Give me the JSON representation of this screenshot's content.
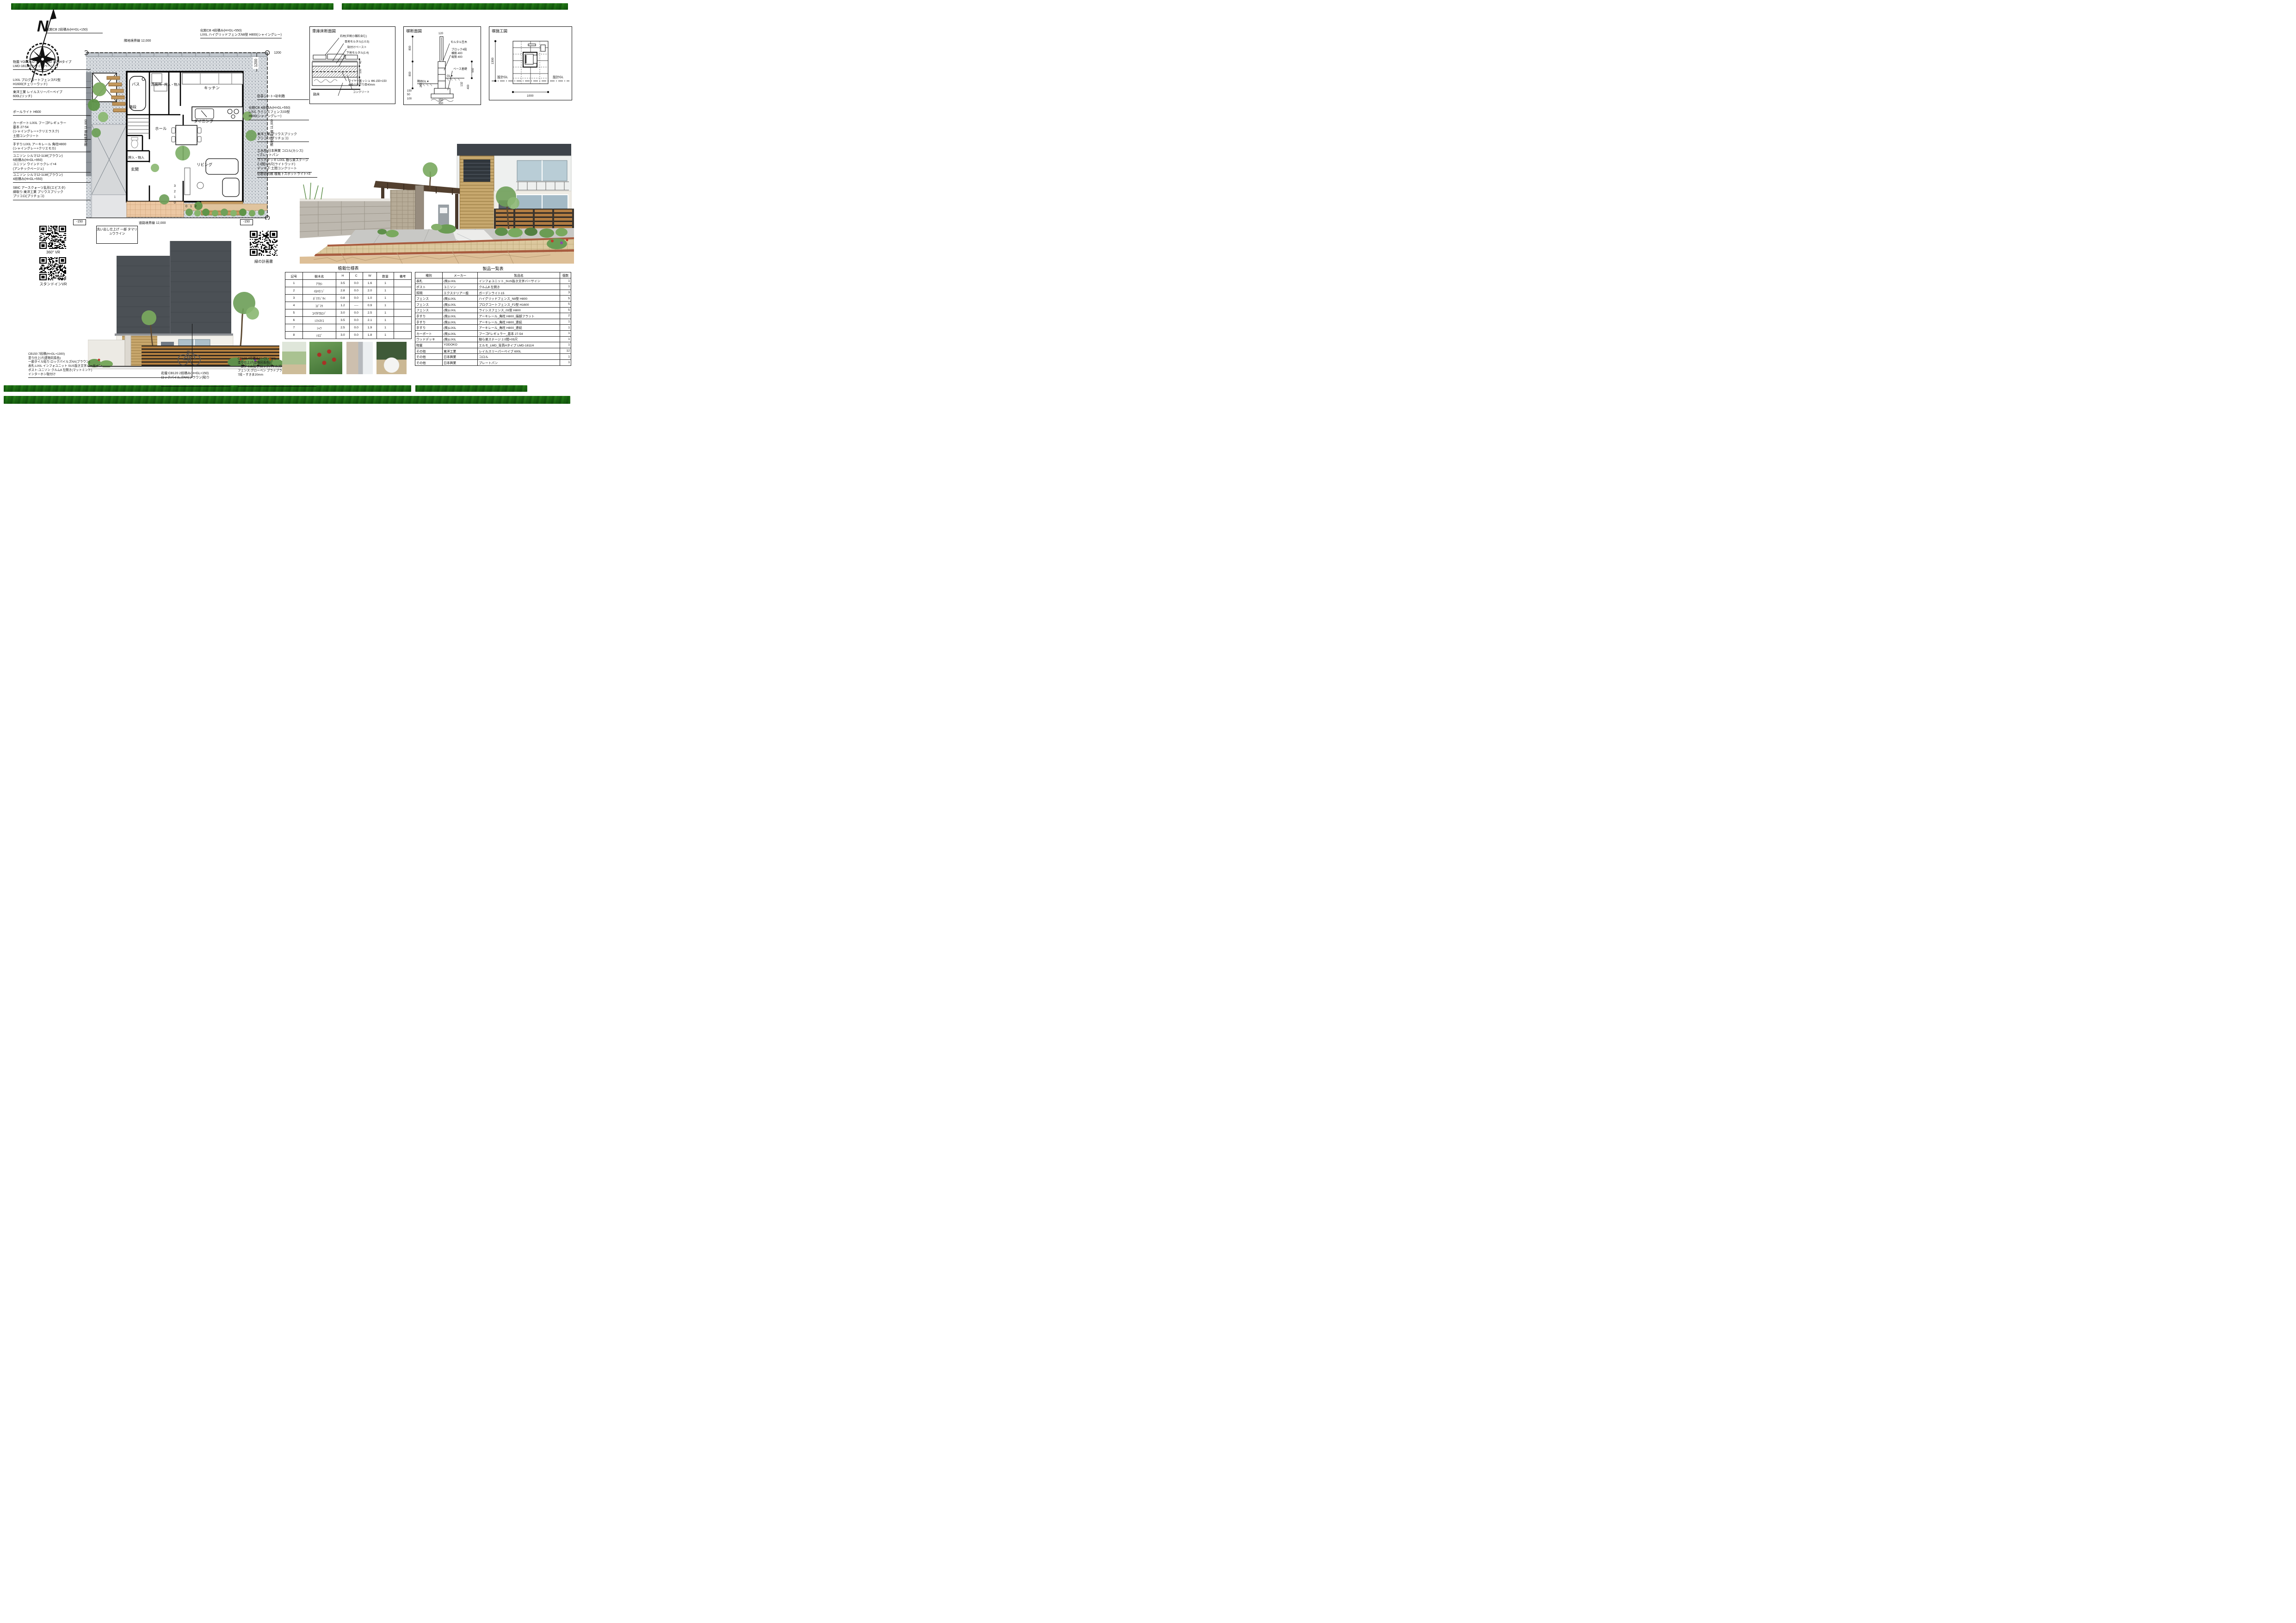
{
  "compass": {
    "n": "N"
  },
  "plan": {
    "label_top_left": "化粧CB 2段積み(H=GL+150)",
    "label_top_right": "化粧CB 4段積み(H=GL+550)\nLIXIL ハイグリッドフェンスN8型 H800(シャイングレー)",
    "dim_top": "隣地境界線 12,000",
    "dim_left": "隣地境界線 11,000",
    "dim_right": "隣地境界線 11,000",
    "dim_bottom": "道路境界線 12,000",
    "dim_1200_v": "1200",
    "dim_1200_h": "1200",
    "minus150_left": "-150",
    "minus150_right": "-150",
    "label_washout": "洗い出し仕上げ\n一部 タマリュウライン",
    "labels_left": [
      "物置:YODOKO エルモLMD 背高Hタイプ\nLMD-1811H(カシミヤベージュ)",
      "LIXIL プログコートフェンスF2型\nH1600(チェリーウッド)",
      "東洋工業 レイルスリーパーペイブ\n600L(リッチ)",
      "ポールライト H600",
      "カーポート:LIXIL フーゴFレギュラー\n基本 27-54\n(シャイングレー+クリエラスク)\n土間コンクリート",
      "手すり:LIXIL アーキレール 角柱H800\n(シャイングレー+クリエモカ)",
      "ユニソン シルマ12-1LW(ブラウン)\n6段積み(H=GL+950)\nユニソン ウインドゥクレイ×4\n(アンチックベージュ)",
      "ユニソン シルマ12-1LW(ブラウン)\n4段積み(H=GL+550)",
      "SBIC アースクォーツ乱形(エピスタ)\n縁取り:東洋工業 プリウスブリック\nプリコロ(プリチョコ)"
    ],
    "labels_right": [
      "防草シート+砂利敷",
      "化粧CB 4段積み(H=GL+550)\nLIXIL ライシスフェンス03型\nH800(シャイングレー)",
      "東洋工業 プリウスブリック\nプリコロ(プリチョコ)",
      "立水栓:日本興業 コロル(カシス)\n+プレートパン",
      "ウッドデッキ:LIXIL 樹ら楽ステージ\n2.0間×05尺(ライトウッド)\nデッキ下:土間コンクリート",
      "化粧砂利敷 植栽下スポットライト×3"
    ],
    "rooms": {
      "bath": "バス",
      "lavatory": "洗面所",
      "closet1": "押入・物入",
      "kitchen": "キッチン",
      "stairs": "階段",
      "hall": "ホール",
      "dining": "ダイニング",
      "closet2": "押入・物入",
      "entrance": "玄関",
      "living": "リビング"
    },
    "steps_v": [
      "3",
      "2",
      "1",
      "0"
    ],
    "steps_h": [
      "0",
      "1",
      "2"
    ]
  },
  "details": {
    "garage": {
      "title": "車庫床断面図",
      "labels": [
        "石材(半割小舗石含む)",
        "目地モルタル(1:0.5)",
        "貼付けペースト",
        "下地モルタル(1:4)",
        "ワイヤーメッシュ Φ6-150×150\n※最小かぶり厚40mm",
        "コンクリート",
        "クラッシャラン C40-0"
      ],
      "label_roadbed": "路床",
      "dims": [
        "40",
        "100",
        "100"
      ]
    },
    "wall_section": {
      "title": "塀断面図",
      "label_coping": "モルタル笠木",
      "label_block": "ブロック4段\n横筋 400\n縦筋 400",
      "label_base": "ベース基礎",
      "label_gl": "GL▼",
      "label_ngl": "隣地GL▼",
      "dim_top": "120",
      "dims_left": [
        "800",
        "800",
        "282",
        "150",
        "50",
        "100"
      ],
      "dims_right": [
        "550",
        "132",
        "400"
      ],
      "dims_bottom": [
        "350",
        "450"
      ]
    },
    "wall_elev": {
      "title": "塀施工図",
      "label_gl_left": "設計GL",
      "label_gl_right": "設計GL",
      "dim_h": "1300",
      "dim_w": "1000"
    }
  },
  "qr": {
    "vr360_label": "360°  VR",
    "standin_label": "スタンドインVR",
    "greenplan_label": "緑の計画書"
  },
  "elevation": {
    "label_cb150": "CB150 7段積(H=GL+1300)\n塗り仕上げ(建物同系色)\n一部タイル貼り:ロックパイルズNX(ブラウン)\n表札:LIXIL インフォユニット SUS抜き文字バーサイン\nポスト:ユニソン クルムⅡ 左開き(マットミント)\nインターホン取付け",
    "label_flowerbed": "花壇:CB120 2段積み(H=GL+150)\nロックパイルズNX(ブラウン)貼り",
    "label_cb120": "CB120 4段積み(H=GL+550)\n塗り仕上げ(建物同系色)\n一部タイル貼り:ロックパイルズNX(ブラウン)\nフェンス:グローベン プラドプラス(サンド)\n7段・すきま20mm"
  },
  "tables": {
    "planting": {
      "title": "植栽仕様表",
      "headers": [
        "記号",
        "樹木名",
        "H",
        "C",
        "W",
        "数量",
        "備考"
      ],
      "rows": [
        [
          "1",
          "ｱﾗｶｼ",
          "3.5",
          "0.0",
          "1.6",
          "1",
          ""
        ],
        [
          "2",
          "ｲﾛﾊﾓﾐｼﾞ",
          "2.8",
          "0.0",
          "2.0",
          "1",
          ""
        ],
        [
          "3",
          "ｶﾞｸｱｼﾞｻｲ",
          "0.8",
          "0.0",
          "1.0",
          "1",
          ""
        ],
        [
          "4",
          "ｺﾃﾞﾏﾘ",
          "1.2",
          "----",
          "0.9",
          "1",
          ""
        ],
        [
          "5",
          "ｺﾊｳﾁﾜｶｴﾃﾞ",
          "3.0",
          "0.0",
          "2.5",
          "1",
          ""
        ],
        [
          "6",
          "ｼﾏﾄﾈﾘｺ",
          "3.5",
          "0.0",
          "2.1",
          "1",
          ""
        ],
        [
          "7",
          "ｼｬﾗ",
          "2.5",
          "0.0",
          "1.9",
          "1",
          ""
        ],
        [
          "8",
          "ｿﾖｺﾞ",
          "3.0",
          "0.0",
          "1.8",
          "1",
          ""
        ]
      ]
    },
    "products": {
      "title": "製品一覧表",
      "headers": [
        "種別",
        "メーカー",
        "製品名",
        "個数"
      ],
      "rows": [
        [
          "表札",
          "(株)LIXIL",
          "インフォユニット_SUS抜き文字バーサイン",
          "1"
        ],
        [
          "ポスト",
          "ユニソン",
          "クルムⅡ 左開き",
          "1"
        ],
        [
          "照明",
          "エクステリア一般",
          "ガーデンライト15",
          "3"
        ],
        [
          "フェンス",
          "(株)LIXIL",
          "ハイグリッドフェンス_N8型 H800",
          "5"
        ],
        [
          "フェンス",
          "(株)LIXIL",
          "プログコートフェンス_F2型 H1600",
          "5"
        ],
        [
          "フェンス",
          "(株)LIXIL",
          "ライシスフェンス_03型 H800",
          "5"
        ],
        [
          "手すり",
          "(株)LIXIL",
          "アーキレール_角柱 H800_端部フラット",
          "2"
        ],
        [
          "手すり",
          "(株)LIXIL",
          "アーキレール_角柱 H800_連続",
          "1"
        ],
        [
          "手すり",
          "(株)LIXIL",
          "アーキレール_角柱 H800_連続",
          "1"
        ],
        [
          "カーポート",
          "(株)LIXIL",
          "フーゴFレギュラー_基本 27-54",
          "1"
        ],
        [
          "ウッドデッキ",
          "(株)LIXIL",
          "樹ら楽ステージ 2.0間×05尺",
          "1"
        ],
        [
          "物置",
          "YODOKO",
          "エルモ_LMD_背高Hタイプ LMD-1811H",
          "1"
        ],
        [
          "その他",
          "東洋工業",
          "レイルスリーパーペイブ 600L",
          "12"
        ],
        [
          "その他",
          "日本興業",
          "コロル",
          "1"
        ],
        [
          "その他",
          "日本興業",
          "プレートパン",
          "1"
        ]
      ]
    }
  }
}
